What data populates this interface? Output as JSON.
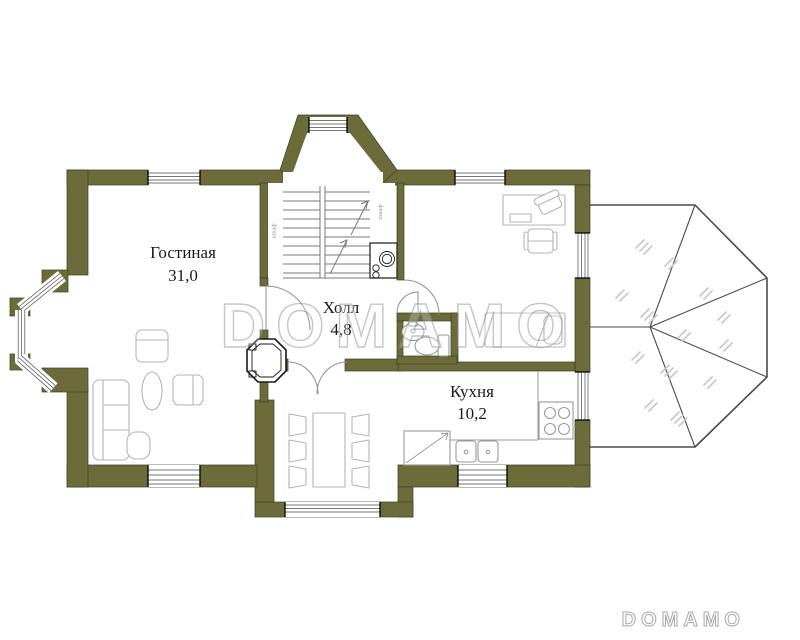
{
  "plan": {
    "title": "floor-plan",
    "rooms": {
      "living": {
        "name": "Гостиная",
        "area": "31,0"
      },
      "hall": {
        "name": "Холл",
        "area": "4,8"
      },
      "kitchen": {
        "name": "Кухня",
        "area": "10,2"
      }
    },
    "labels": {
      "closet_left": "шкаф",
      "closet_right": "шкаф"
    },
    "colors": {
      "wall": "#6c6c3b",
      "wall_outline": "#3e3e24",
      "furniture": "#b5b5b5",
      "text": "#1a1a1a",
      "roof_line": "#4a4a4a",
      "roof_hatch": "#c9c9c9",
      "watermark": "#979797"
    }
  },
  "watermark": {
    "center": "DOMAMO",
    "corner": "DOMAMO"
  }
}
